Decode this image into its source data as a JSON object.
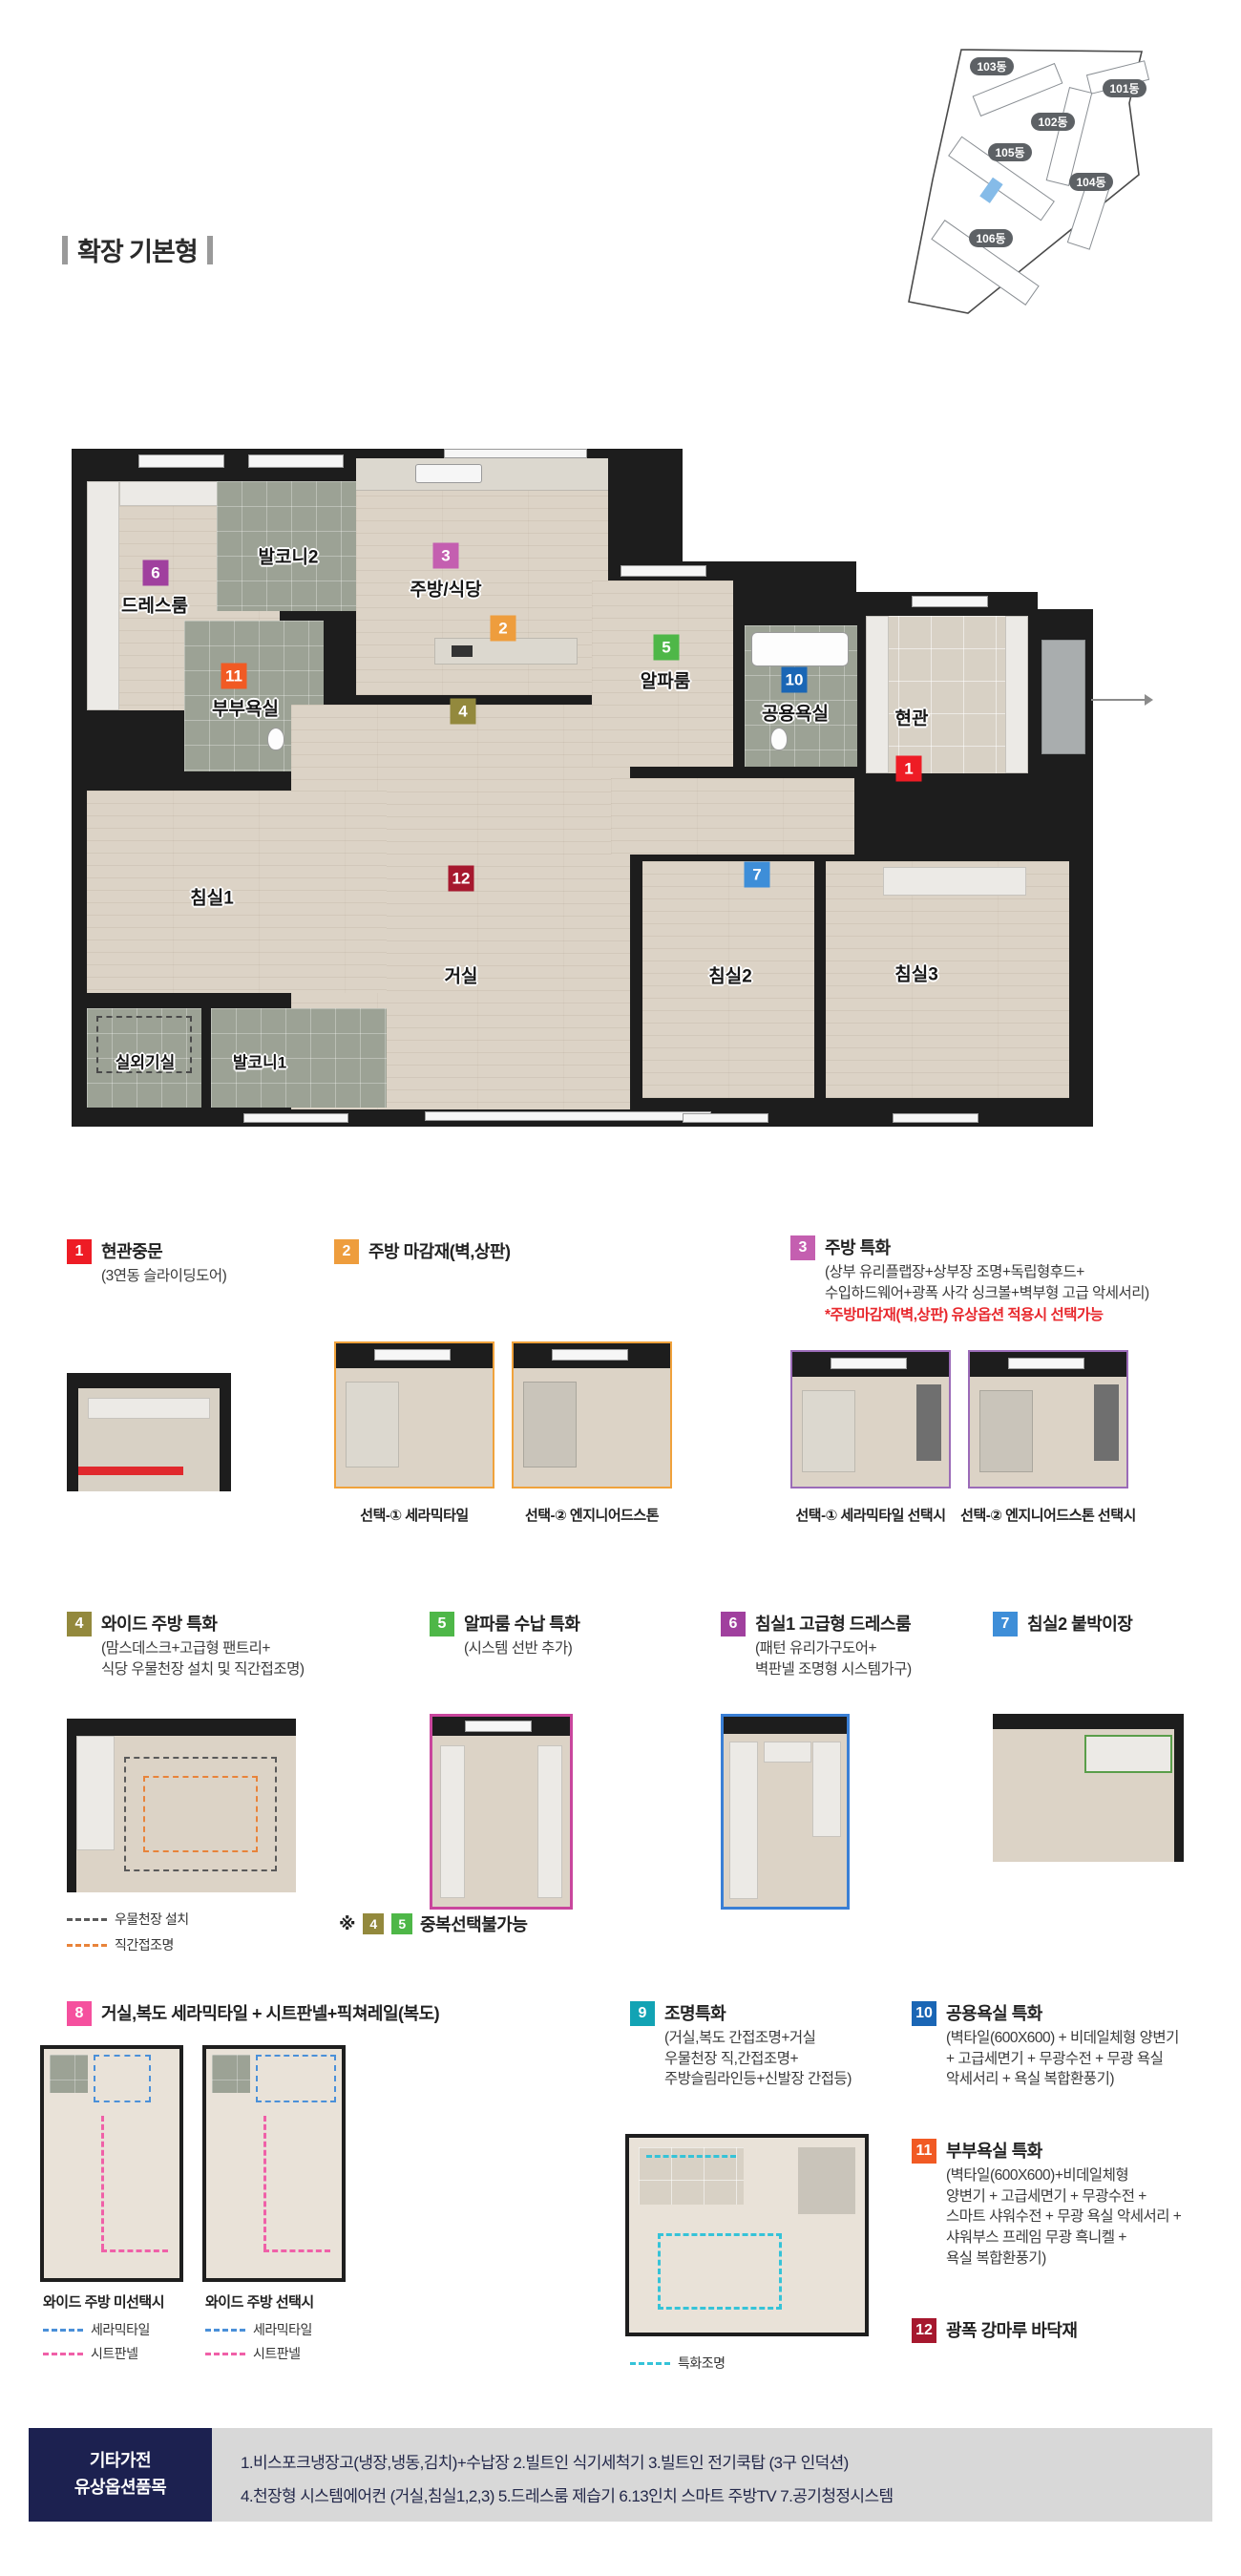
{
  "page": {
    "title": "확장 기본형"
  },
  "site_plan": {
    "pill_color": "#5d6165",
    "unit_color": "#85bbe8",
    "buildings": [
      "103동",
      "101동",
      "102동",
      "105동",
      "104동",
      "106동"
    ]
  },
  "floor_plan": {
    "rooms": {
      "entrance": "현관",
      "living": "거실",
      "kitchen": "주방/식당",
      "bed1": "침실1",
      "bed2": "침실2",
      "bed3": "침실3",
      "dress": "드레스룸",
      "master_bath": "부부욕실",
      "common_bath": "공용욕실",
      "alpha": "알파룸",
      "balcony1": "발코니1",
      "balcony2": "발코니2",
      "outdoor_unit": "실외기실"
    }
  },
  "legend": {
    "items": [
      {
        "num": "1",
        "color": "#ee1c25",
        "title": "현관중문",
        "desc": "(3연동 슬라이딩도어)"
      },
      {
        "num": "2",
        "color": "#ee9d3d",
        "title": "주방 마감재(벽,상판)",
        "captions": [
          "선택-① 세라믹타일",
          "선택-② 엔지니어드스톤"
        ]
      },
      {
        "num": "3",
        "color": "#c45fb0",
        "title": "주방 특화",
        "desc": "(상부 유리플랩장+상부장 조명+독립형후드+\n수입하드웨어+광폭 사각 싱크볼+벽부형 고급 악세서리)",
        "note": "*주방마감재(벽,상판) 유상옵션 적용시 선택가능",
        "note_color": "#e8282d",
        "captions": [
          "선택-① 세라믹타일 선택시",
          "선택-② 엔지니어드스톤 선택시"
        ]
      },
      {
        "num": "4",
        "color": "#93893d",
        "title": "와이드 주방 특화",
        "desc": "(맘스데스크+고급형 팬트리+\n식당 우물천장 설치 및 직간접조명)"
      },
      {
        "num": "5",
        "color": "#4eb748",
        "title": "알파룸 수납 특화",
        "desc": "(시스템 선반 추가)"
      },
      {
        "num": "6",
        "color": "#a0409e",
        "title": "침실1 고급형 드레스룸",
        "desc": "(패턴 유리가구도어+\n벽판넬 조명형 시스템가구)"
      },
      {
        "num": "7",
        "color": "#3e8ed8",
        "title": "침실2 붙박이장"
      },
      {
        "num": "8",
        "color": "#f5509e",
        "title": "거실,복도 세라믹타일 + 시트판넬+픽쳐레일(복도)",
        "captions": [
          "와이드 주방 미선택시",
          "와이드 주방 선택시"
        ]
      },
      {
        "num": "9",
        "color": "#12a3b4",
        "title": "조명특화",
        "desc": "(거실,복도 간접조명+거실\n우물천장 직,간접조명+\n주방슬림라인등+신발장 간접등)"
      },
      {
        "num": "10",
        "color": "#1a66b5",
        "title": "공용욕실 특화",
        "desc": "(벽타일(600X600) + 비데일체형 양변기\n+ 고급세면기 + 무광수전 + 무광 욕실\n악세서리 + 욕실 복합환풍기)"
      },
      {
        "num": "11",
        "color": "#f15a24",
        "title": "부부욕실 특화",
        "desc": "(벽타일(600X600)+비데일체형\n양변기 + 고급세면기 + 무광수전 +\n스마트 샤워수전 + 무광 욕실 악세서리 +\n샤워부스 프레임 무광 흑니켈 +\n욕실 복합환풍기)"
      },
      {
        "num": "12",
        "color": "#a6182e",
        "title": "광폭 강마루 바닥재"
      }
    ],
    "dup_note": {
      "mark": "※",
      "text": "중복선택불가능"
    },
    "dashes": {
      "well": {
        "label": "우물천장 설치",
        "color": "#5a5a5a"
      },
      "indirect": {
        "label": "직간접조명",
        "color": "#e8833a"
      },
      "ceramic": {
        "label": "세라믹타일",
        "color": "#4a90d9"
      },
      "sheet": {
        "label": "시트판넬",
        "color": "#f060a8"
      },
      "light": {
        "label": "특화조명",
        "color": "#35c3d8"
      }
    }
  },
  "footer": {
    "label": "기타가전\n유상옵션품목",
    "line1": "1.비스포크냉장고(냉장,냉동,김치)+수납장  2.빌트인 식기세척기 3.빌트인 전기쿡탑 (3구 인덕션)",
    "line2": "4.천장형 시스템에어컨 (거실,침실1,2,3) 5.드레스룸 제습기  6.13인치 스마트 주방TV  7.공기청정시스템"
  }
}
